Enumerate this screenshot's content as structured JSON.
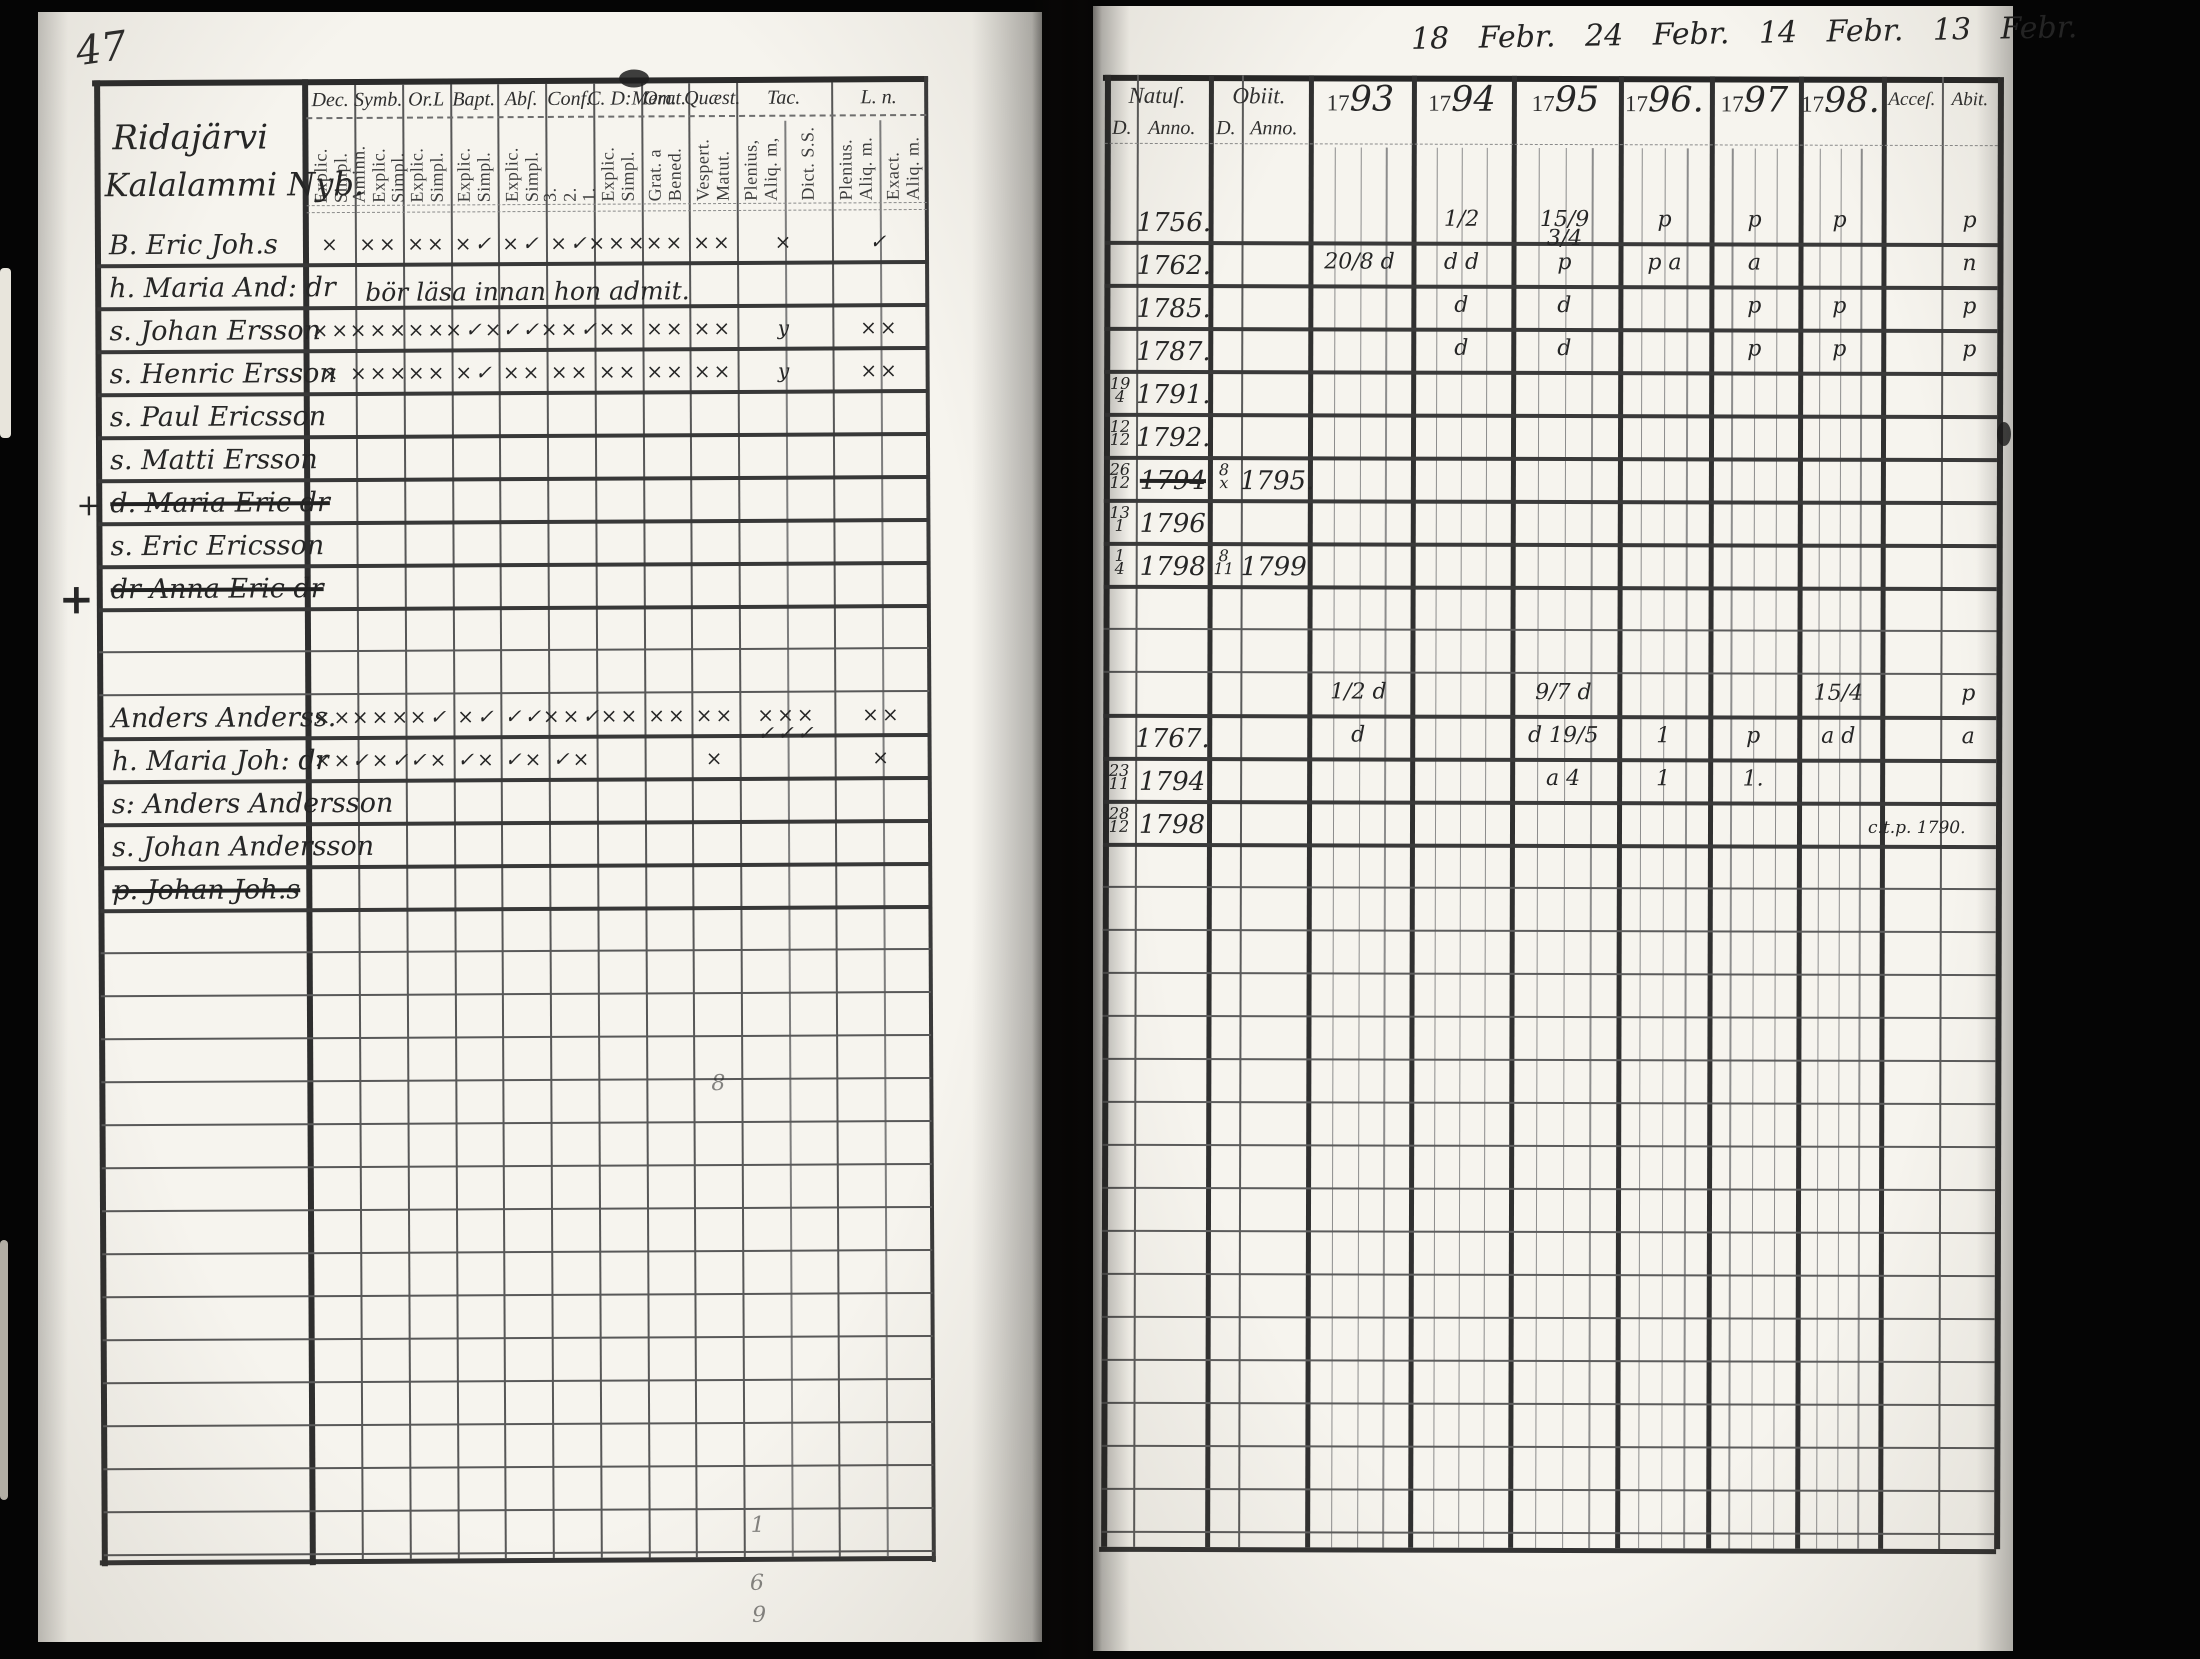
{
  "colors": {
    "page": "#f6f4ee",
    "ink": "#262626",
    "grid": "#555555",
    "grid_heavy": "#2e2e2e"
  },
  "page_left": {
    "page_number": "47",
    "section": {
      "line1": "Ridajärvi",
      "line2": "Kalalammi Nyb."
    },
    "columns": [
      {
        "label": "Dec.",
        "sub": [
          "Explic.",
          "Simpl."
        ]
      },
      {
        "label": "Symb.",
        "sub": [
          "Aminn.",
          "Explic.",
          "Simpl."
        ]
      },
      {
        "label": "Or.L",
        "sub": [
          "Explic.",
          "Simpl."
        ]
      },
      {
        "label": "Bapt.",
        "sub": [
          "Explic.",
          "Simpl."
        ]
      },
      {
        "label": "Abſ.",
        "sub": [
          "Explic.",
          "Simpl."
        ]
      },
      {
        "label": "Conf.",
        "sub": [
          "3.",
          "2.",
          "1."
        ]
      },
      {
        "label": "C. D:Mem.",
        "sub": [
          "Explic.",
          "Simpl."
        ]
      },
      {
        "label": "Orat.",
        "sub": [
          "Grat. a",
          "Bened."
        ]
      },
      {
        "label": "Quæst.",
        "sub": [
          "Vespert.",
          "Matut."
        ]
      },
      {
        "label": "Tac.",
        "sub": [
          "Plenius,",
          "Aliq. m,"
        ],
        "sub2": [
          "Dict. S.S."
        ]
      },
      {
        "label": "L. n.",
        "sub": [
          "Plenius.",
          "Aliq. m."
        ],
        "sub2": [
          "Exact.",
          "Aliq. m."
        ]
      }
    ],
    "rows": [
      {
        "prefix": "B.",
        "name": "Eric Joh.s",
        "marks": [
          "×",
          "××",
          "××",
          "×✓",
          "×✓",
          "×✓",
          "×××",
          "××",
          "××",
          "×",
          "✓"
        ]
      },
      {
        "prefix": "h.",
        "name": "Maria And: dr",
        "note": "bör läsa innan hon admit."
      },
      {
        "prefix": "s.",
        "name": "Johan Ersson",
        "marks": [
          "××",
          "×××",
          "××",
          "×✓×",
          "✓✓",
          "××✓",
          "××",
          "××",
          "××",
          "y",
          "××"
        ]
      },
      {
        "prefix": "s.",
        "name": "Henric Ersson",
        "marks": [
          "×",
          "×××",
          "××",
          "×✓",
          "××",
          "××",
          "××",
          "××",
          "××",
          "y",
          "××"
        ]
      },
      {
        "prefix": "s.",
        "name": "Paul Ericsson"
      },
      {
        "prefix": "s.",
        "name": "Matti Ersson"
      },
      {
        "prefix": "d.",
        "name": "Maria Eric dr",
        "struck": true,
        "margin": "+"
      },
      {
        "prefix": "s.",
        "name": "Eric Ericsson"
      },
      {
        "prefix": "dr",
        "name": "Anna Eric dr",
        "struck": true,
        "margin": "+",
        "margin_big": true
      },
      {},
      {},
      {
        "prefix": "",
        "name": "Anders Anderss.",
        "marks": [
          "××",
          "×××",
          "×✓",
          "×✓",
          "✓✓",
          "××✓",
          "××",
          "××",
          "××",
          "×××\n✓✓✓",
          "××"
        ]
      },
      {
        "prefix": "h.",
        "name": "Maria Joh: dr",
        "marks": [
          "××",
          "✓×✓",
          "✓×",
          "✓×",
          "✓×",
          "✓×",
          "",
          "",
          "×",
          "",
          "×"
        ]
      },
      {
        "prefix": "s:",
        "name": "Anders Andersson"
      },
      {
        "prefix": "s.",
        "name": "Johan Andersson"
      },
      {
        "prefix": "p.",
        "name": "Johan Joh.s",
        "struck": true
      }
    ],
    "stray_marks": [
      {
        "t": "8",
        "x": 710,
        "y": 1072
      },
      {
        "t": "1",
        "x": 747,
        "y": 1514
      },
      {
        "t": "6",
        "x": 746,
        "y": 1572
      },
      {
        "t": "9",
        "x": 748,
        "y": 1604
      }
    ]
  },
  "page_right": {
    "dates_note": "18 Febr.  24 Febr.  14 Febr.  13 Febr.",
    "header": {
      "natus": "Natuſ.",
      "obiit": "Obiit.",
      "d_label": "D.",
      "anno_label": "Anno.",
      "acces": "Acceſ.",
      "abit": "Abit.",
      "years": [
        {
          "printed": "17",
          "script": "93"
        },
        {
          "printed": "17",
          "script": "94"
        },
        {
          "printed": "17",
          "script": "95"
        },
        {
          "printed": "17",
          "script": "96."
        },
        {
          "printed": "17",
          "script": "97"
        },
        {
          "printed": "17",
          "script": "98."
        }
      ]
    },
    "rows": [
      {
        "natus_anno": "1756.",
        "marks": [
          {
            "c": "y1794",
            "t": "1/2"
          },
          {
            "c": "y1795",
            "t": "15/9 3/4"
          },
          {
            "c": "y1796",
            "t": "p"
          },
          {
            "c": "y1797",
            "t": "p"
          },
          {
            "c": "y1798",
            "t": "p"
          },
          {
            "c": "abit",
            "t": "p"
          }
        ]
      },
      {
        "natus_anno": "1762.",
        "marks": [
          {
            "c": "y1793",
            "t": "20/8 d"
          },
          {
            "c": "y1794",
            "t": "d d"
          },
          {
            "c": "y1795",
            "t": "p"
          },
          {
            "c": "y1796",
            "t": "p a"
          },
          {
            "c": "y1797",
            "t": "a"
          },
          {
            "c": "abit",
            "t": "n"
          }
        ]
      },
      {
        "natus_anno": "1785.",
        "marks": [
          {
            "c": "y1794",
            "t": "d"
          },
          {
            "c": "y1795",
            "t": "d"
          },
          {
            "c": "y1797",
            "t": "p"
          },
          {
            "c": "y1798",
            "t": "p"
          },
          {
            "c": "abit",
            "t": "p"
          }
        ]
      },
      {
        "natus_anno": "1787.",
        "marks": [
          {
            "c": "y1794",
            "t": "d"
          },
          {
            "c": "y1795",
            "t": "d"
          },
          {
            "c": "y1797",
            "t": "p"
          },
          {
            "c": "y1798",
            "t": "p"
          },
          {
            "c": "abit",
            "t": "p"
          }
        ]
      },
      {
        "natus_d": {
          "top": "19",
          "bot": "4"
        },
        "natus_anno": "1791."
      },
      {
        "natus_d": {
          "top": "12",
          "bot": "12"
        },
        "natus_anno": "1792."
      },
      {
        "natus_d": {
          "top": "26",
          "bot": "12"
        },
        "natus_anno": "1794",
        "struck": true,
        "obiit_d": {
          "top": "8",
          "bot": "x"
        },
        "obiit_anno": "1795."
      },
      {
        "natus_d": {
          "top": "13",
          "bot": "1"
        },
        "natus_anno": "1796"
      },
      {
        "natus_d": {
          "top": "1",
          "bot": "4"
        },
        "natus_anno": "1798",
        "obiit_d": {
          "top": "8",
          "bot": "11"
        },
        "obiit_anno": "1799"
      },
      {},
      {},
      {
        "marks": [
          {
            "c": "y1793",
            "t": "1/2 d"
          },
          {
            "c": "y1795",
            "t": "9/7 d"
          },
          {
            "c": "y1798",
            "t": "15/4"
          },
          {
            "c": "abit",
            "t": "p"
          }
        ]
      },
      {
        "natus_anno": "1767.",
        "marks": [
          {
            "c": "y1793",
            "t": "d"
          },
          {
            "c": "y1795",
            "t": "d 19/5"
          },
          {
            "c": "y1796",
            "t": "1"
          },
          {
            "c": "y1797",
            "t": "p"
          },
          {
            "c": "y1798",
            "t": "a d"
          },
          {
            "c": "abit",
            "t": "a"
          }
        ]
      },
      {
        "natus_d": {
          "top": "23",
          "bot": "11"
        },
        "natus_anno": "1794",
        "marks": [
          {
            "c": "y1795",
            "t": "a 4"
          },
          {
            "c": "y1796",
            "t": "1"
          },
          {
            "c": "y1797",
            "t": "1."
          }
        ]
      },
      {
        "natus_d": {
          "top": "28",
          "bot": "12"
        },
        "natus_anno": "1798",
        "note": "c.t.p. 1790."
      },
      {}
    ]
  }
}
